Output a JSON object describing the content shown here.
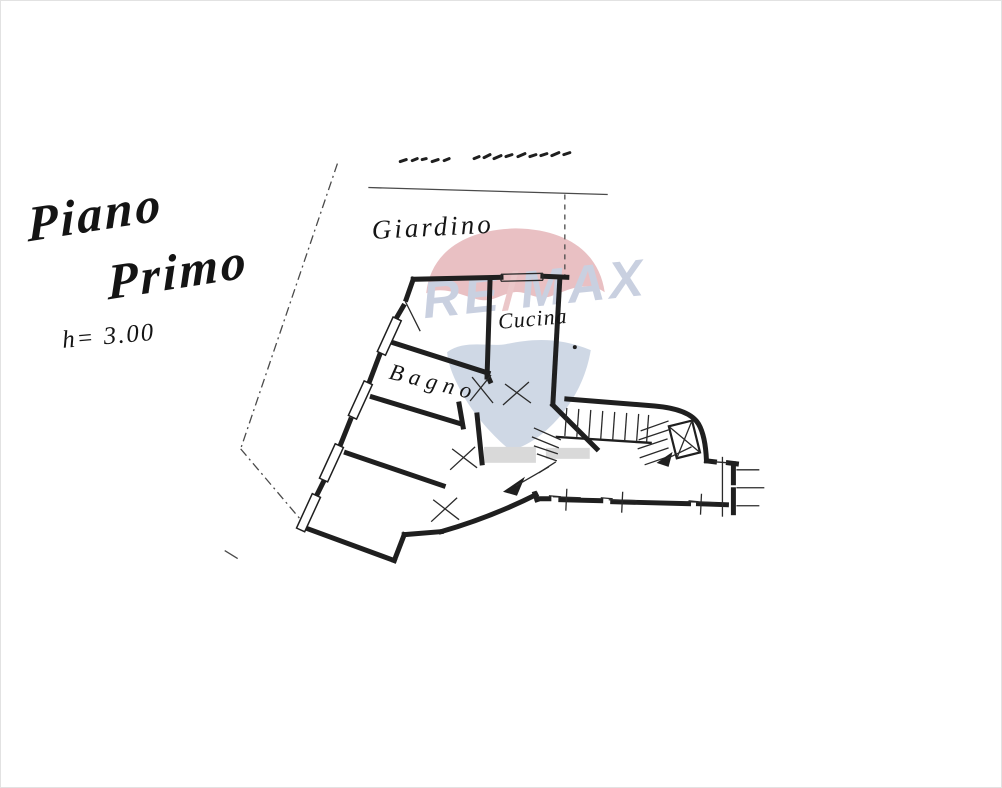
{
  "document": {
    "title": {
      "line1": "Piano",
      "line2": "Primo"
    },
    "height_note": "h= 3.00",
    "room_labels": {
      "garden": "Giardino",
      "kitchen": "Cucina",
      "bathroom": "Bagno"
    }
  },
  "watermark": {
    "brand_left": "RE",
    "brand_slash": "/",
    "brand_right": "MAX",
    "colors": {
      "balloon_top_red": "#dc9ba0",
      "balloon_bottom_blue": "#b3c1d6",
      "letters_blue": "#a9b4ce",
      "slash_red": "#dfa6a9",
      "basket_gray": "#c2c2c2"
    }
  },
  "drawing": {
    "ink_color": "#1f1f1f",
    "paper_color": "#ffffff"
  }
}
